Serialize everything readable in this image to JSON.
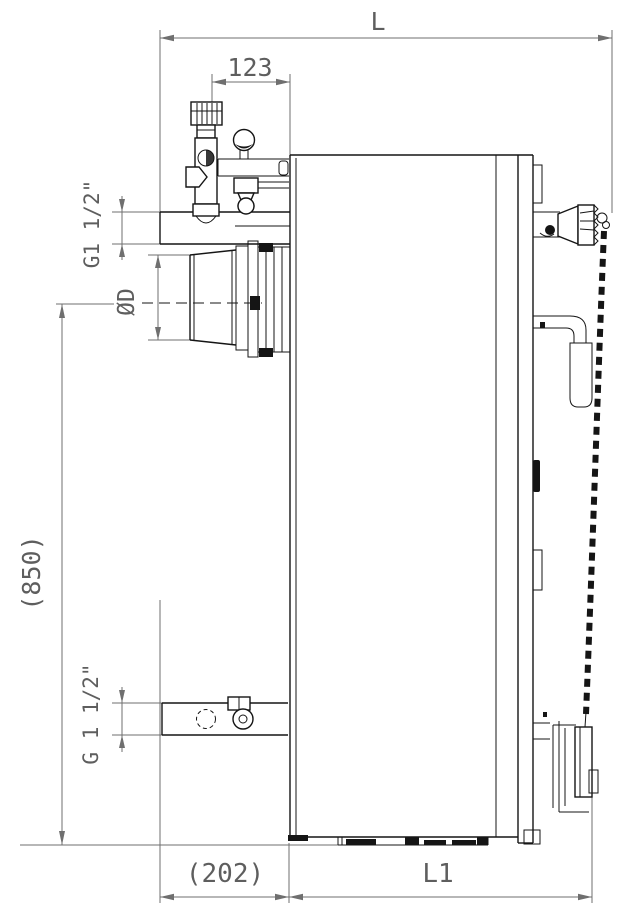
{
  "page": {
    "background": "#ffffff"
  },
  "drawing": {
    "type": "technical-side-elevation",
    "colors": {
      "outline": "#151515",
      "dimension": "#6f6f6f",
      "background": "#ffffff"
    },
    "labels": {
      "overall_depth": "L",
      "valve_offset": "123",
      "top_thread": "G1 1/2\"",
      "flue_diameter": "ØD",
      "overall_height": "(850)",
      "bottom_thread": "G 1 1/2\"",
      "front_projection": "(202)",
      "body_depth": "L1"
    }
  }
}
